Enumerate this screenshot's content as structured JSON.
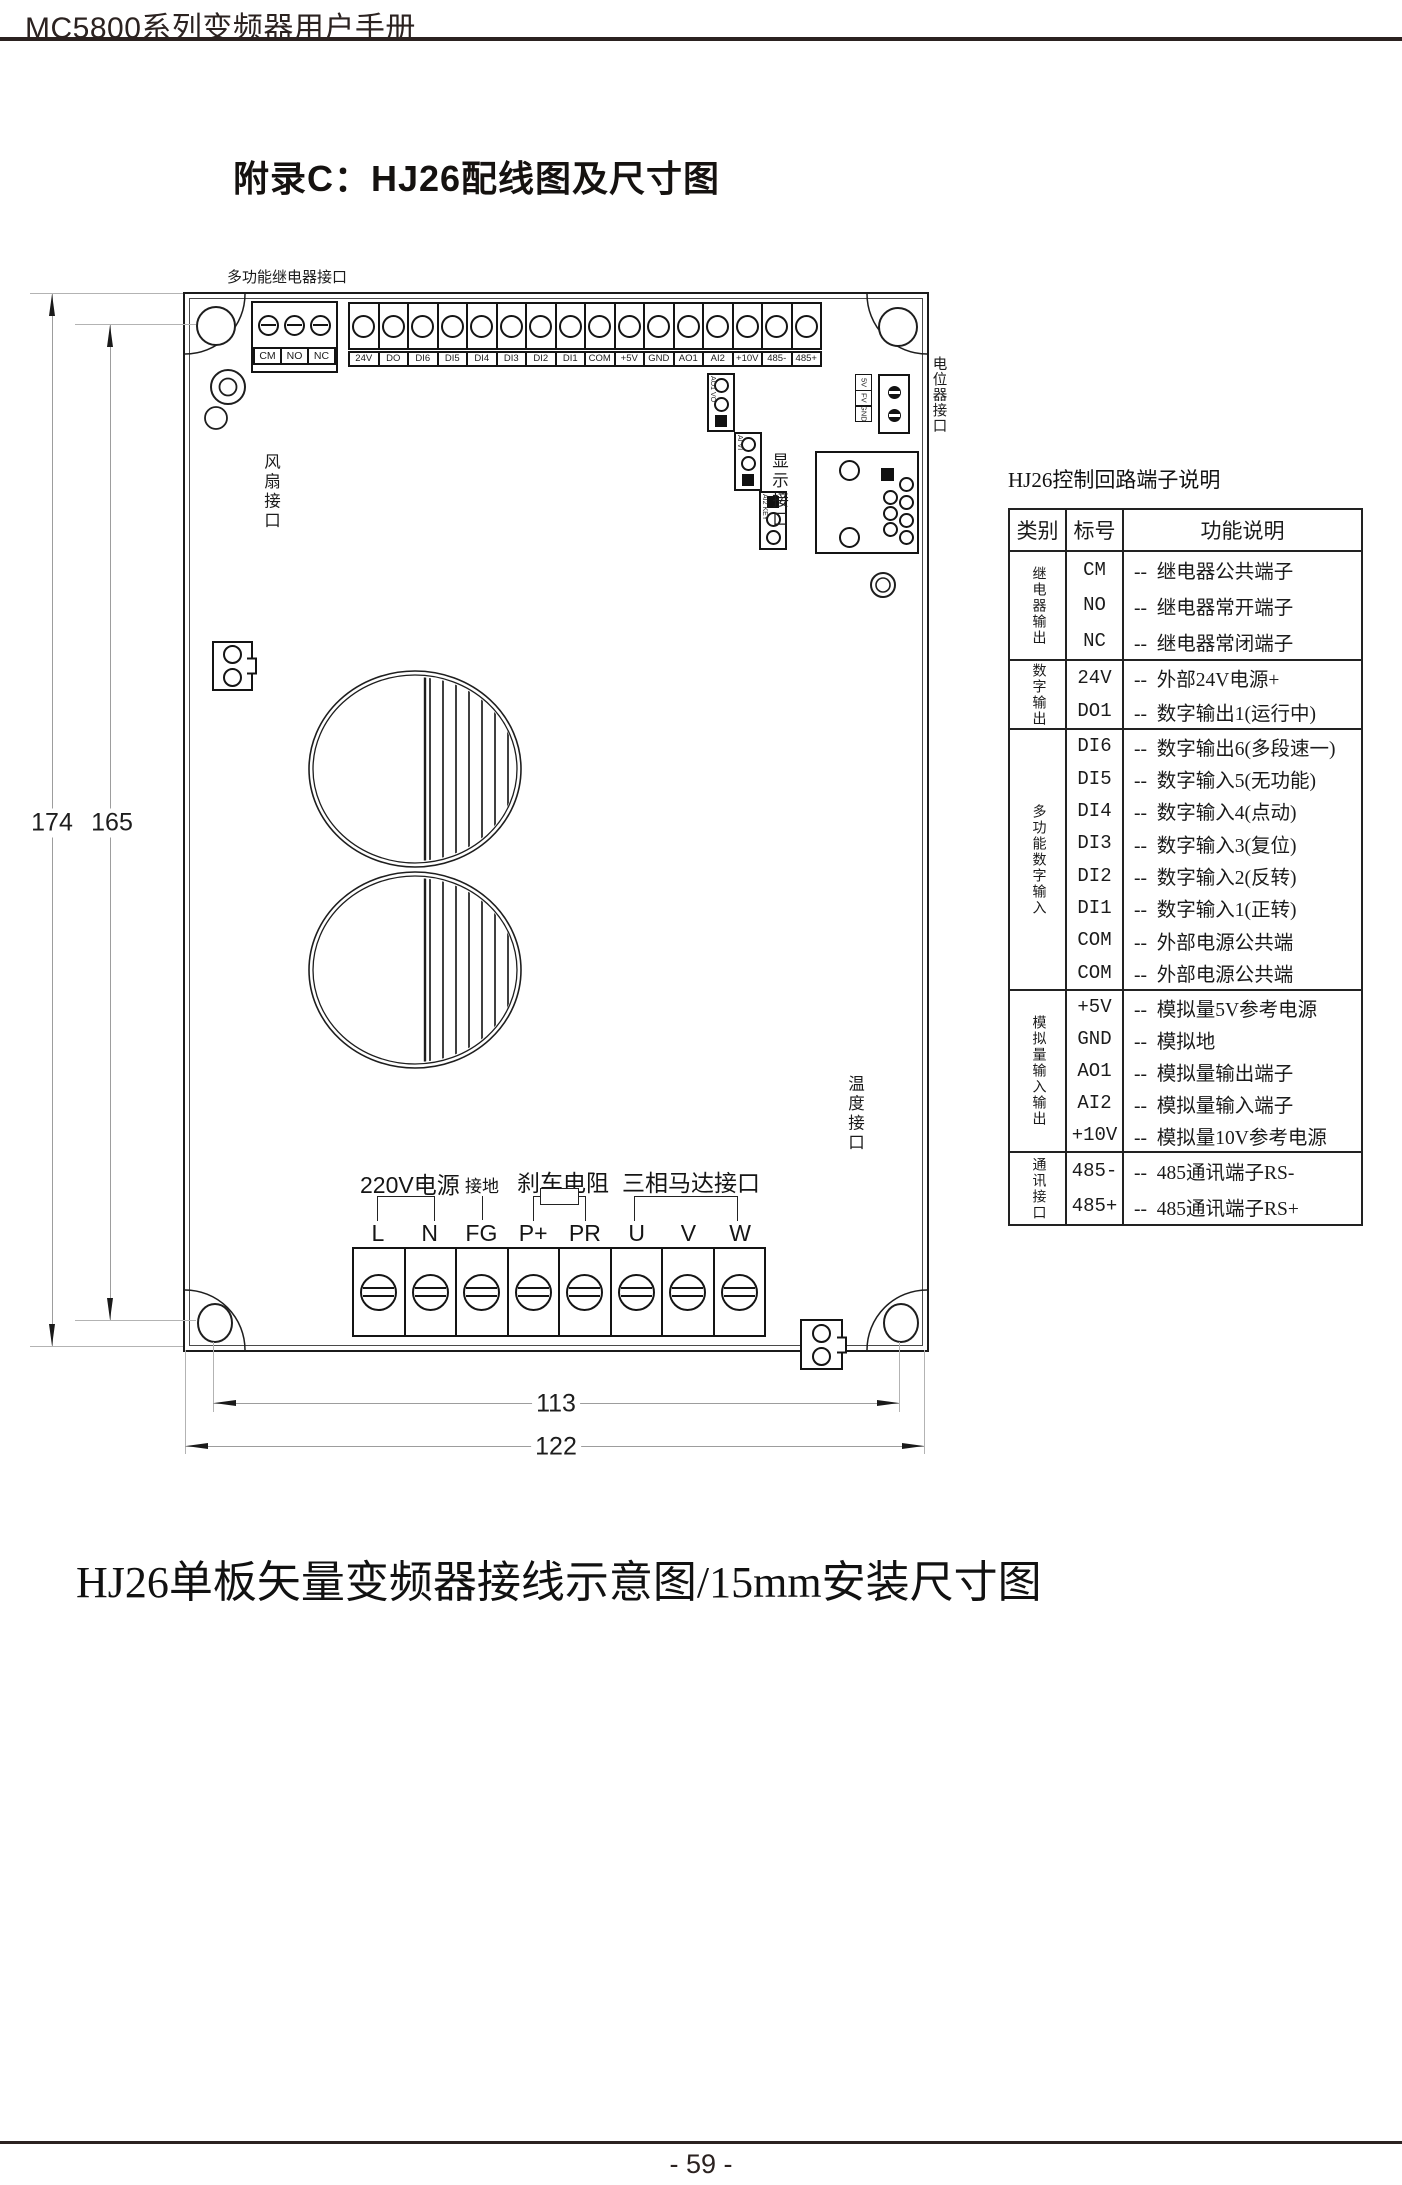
{
  "page": {
    "header_title": "MC5800系列变频器用户手册",
    "title": "附录C：HJ26配线图及尺寸图",
    "caption": "HJ26单板矢量变频器接线示意图/15mm安装尺寸图",
    "page_number": "- 59 -"
  },
  "board": {
    "relay_port_label": "多功能继电器接口",
    "relay_terminals": [
      "CM",
      "NO",
      "NC"
    ],
    "control_terminals": [
      "24V",
      "DO",
      "DI6",
      "DI5",
      "DI4",
      "DI3",
      "DI2",
      "DI1",
      "COM",
      "+5V",
      "GND",
      "AO1",
      "AI2",
      "+10V",
      "485-",
      "485+"
    ],
    "jumpers": [
      {
        "labels": "AO1 VO"
      },
      {
        "labels": "AI VI"
      },
      {
        "labels": "AI2 KEY"
      }
    ],
    "pot_pins": [
      "5V",
      "FV",
      "GND"
    ],
    "pot_port_label": "电位器接口",
    "fan_port_label": "风扇接口",
    "display_port_label": "显示接口",
    "temp_port_label": "温度接口",
    "power_group_labels": {
      "mains": "220V电源",
      "ground": "接地",
      "brake": "刹车电阻",
      "motor": "三相马达接口"
    },
    "power_terminals": [
      "L",
      "N",
      "FG",
      "P+",
      "PR",
      "U",
      "V",
      "W"
    ]
  },
  "dimensions": {
    "outer_height": "174",
    "inner_height": "165",
    "inner_width": "113",
    "outer_width": "122"
  },
  "terminal_table": {
    "title": "HJ26控制回路端子说明",
    "headers": [
      "类别",
      "标号",
      "功能说明"
    ],
    "groups": [
      {
        "category": "继电器输出",
        "rows": [
          [
            "CM",
            "--  继电器公共端子"
          ],
          [
            "NO",
            "--  继电器常开端子"
          ],
          [
            "NC",
            "--  继电器常闭端子"
          ]
        ]
      },
      {
        "category": "数字输出",
        "rows": [
          [
            "24V",
            "--  外部24V电源+"
          ],
          [
            "DO1",
            "--  数字输出1(运行中)"
          ]
        ]
      },
      {
        "category": "多功能数字输入",
        "rows": [
          [
            "DI6",
            "--  数字输出6(多段速一)"
          ],
          [
            "DI5",
            "--  数字输入5(无功能)"
          ],
          [
            "DI4",
            "--  数字输入4(点动)"
          ],
          [
            "DI3",
            "--  数字输入3(复位)"
          ],
          [
            "DI2",
            "--  数字输入2(反转)"
          ],
          [
            "DI1",
            "--  数字输入1(正转)"
          ],
          [
            "COM",
            "--  外部电源公共端"
          ],
          [
            "COM",
            "--  外部电源公共端"
          ]
        ]
      },
      {
        "category": "模拟量输入输出",
        "rows": [
          [
            "+5V",
            "--  模拟量5V参考电源"
          ],
          [
            "GND",
            "--  模拟地"
          ],
          [
            "AO1",
            "--  模拟量输出端子"
          ],
          [
            "AI2",
            "--  模拟量输入端子"
          ],
          [
            "+10V",
            "--  模拟量10V参考电源"
          ]
        ]
      },
      {
        "category": "通讯接口",
        "rows": [
          [
            "485-",
            "--  485通讯端子RS-"
          ],
          [
            "485+",
            "--  485通讯端子RS+"
          ]
        ]
      }
    ]
  }
}
